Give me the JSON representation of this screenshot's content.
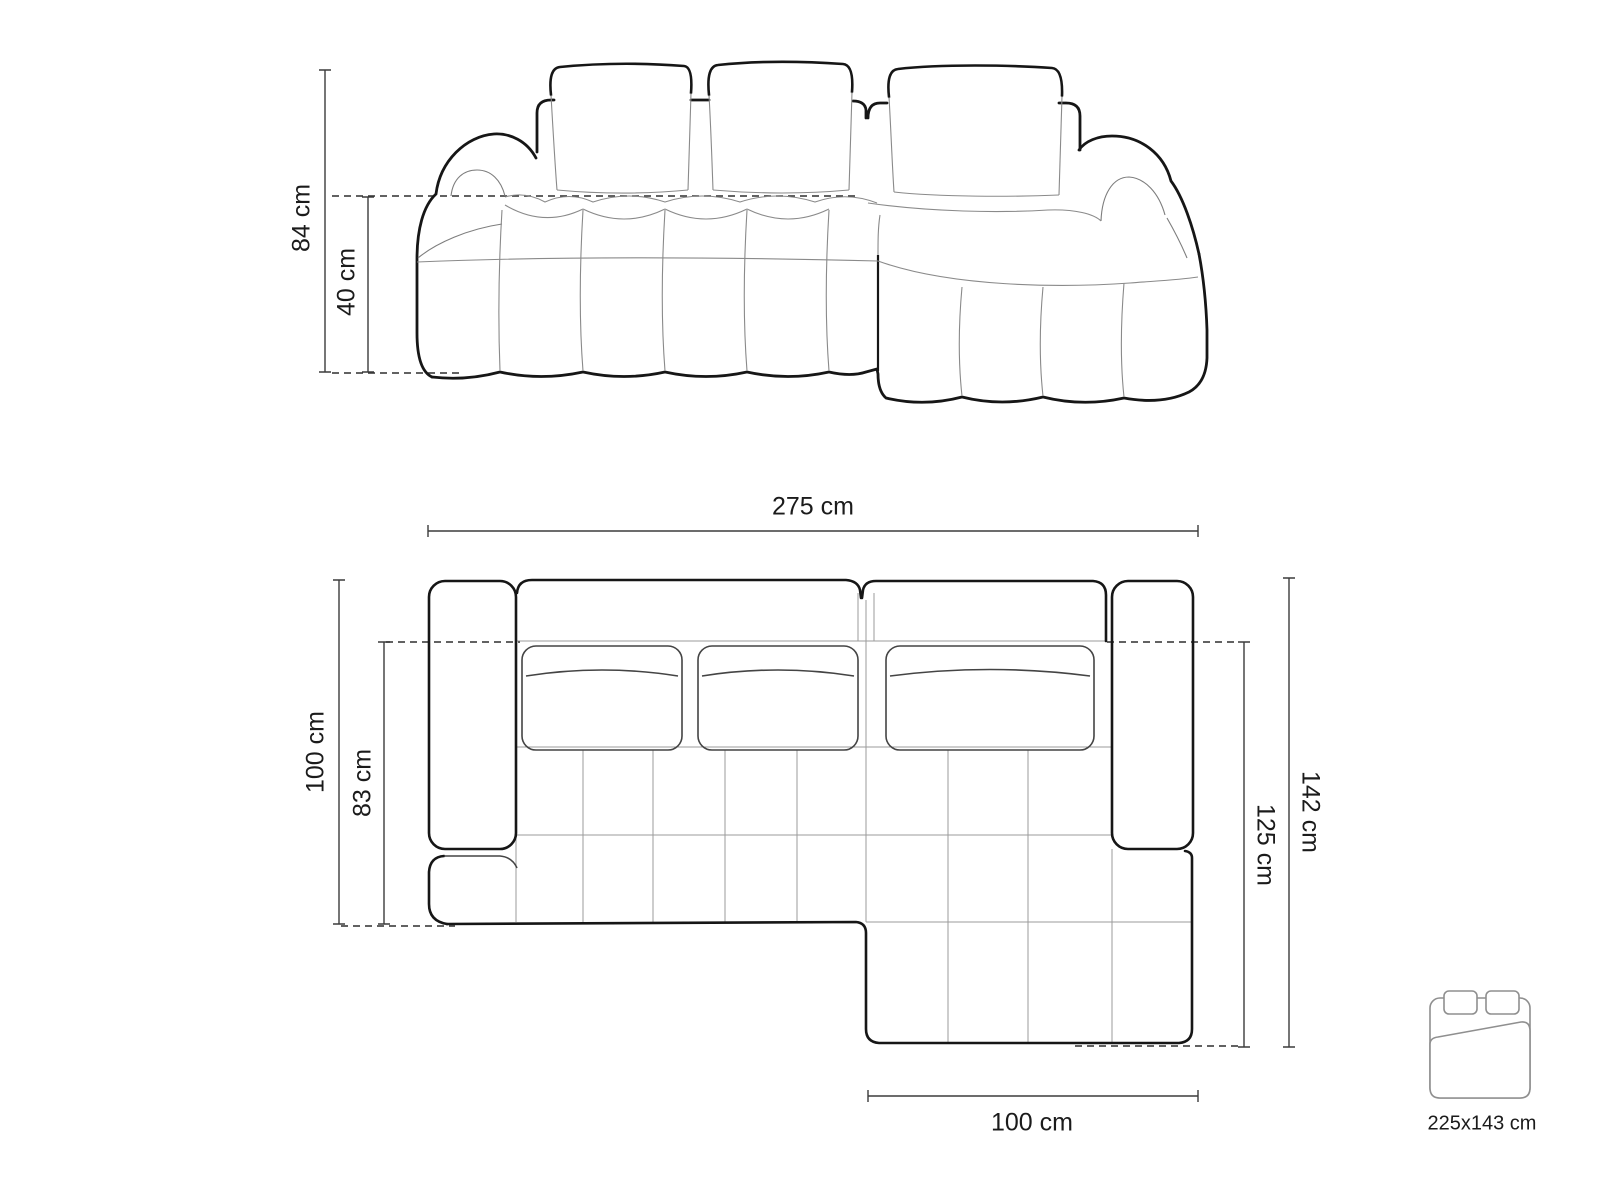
{
  "figure": {
    "kind": "furniture dimension diagram",
    "subject": "modular bubble corner sofa with right chaise, front elevation and top plan view",
    "colors": {
      "background": "#ffffff",
      "outline_bold": "#161616",
      "seam_thin": "#8a8a8a",
      "cushion_medium": "#444444",
      "grid_gray": "#9b9b9b",
      "dimension_line": "#3c3c3c",
      "icon_gray": "#8f8f8f",
      "text": "#1b1b1b"
    }
  },
  "labels": {
    "front_height": "84 cm",
    "front_seat_height": "40 cm",
    "top_width": "275 cm",
    "top_side_depth": "100 cm",
    "top_seat_depth": "83 cm",
    "top_total_depth": "142 cm",
    "top_chaise_depth": "125 cm",
    "top_chaise_width": "100 cm",
    "bed_size": "225x143 cm"
  }
}
